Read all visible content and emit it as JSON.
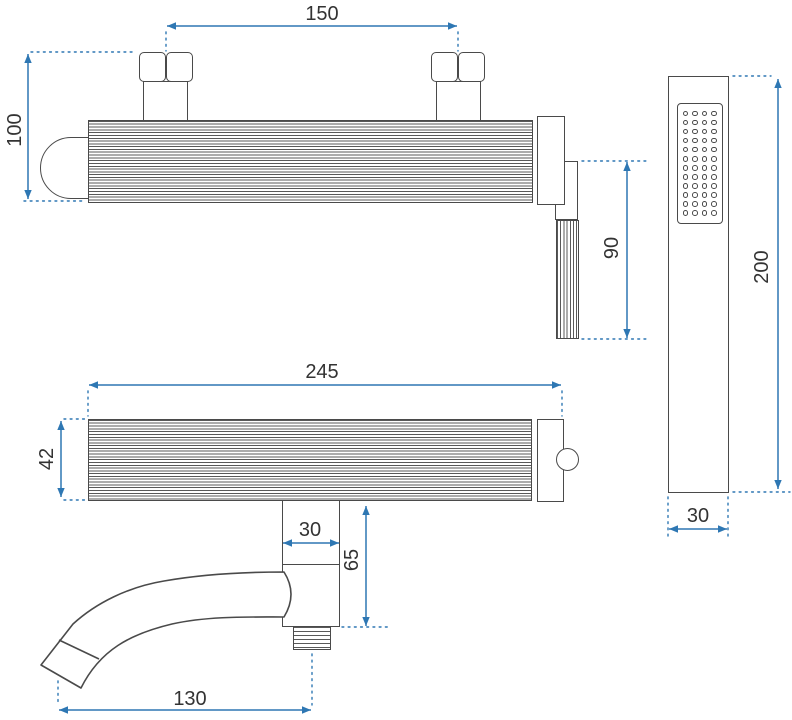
{
  "drawing": {
    "type": "technical dimension drawing",
    "subject": "wall-mounted bath shower mixer with hand shower",
    "unit": "mm",
    "colors": {
      "outline": "#4a4a4a",
      "dimension": "#2e77b3",
      "label": "#333333",
      "background": "#ffffff"
    }
  },
  "views": {
    "front": {
      "name": "mixer front view",
      "dims": {
        "mount_spacing": "150",
        "height": "100",
        "hose_outlet_length": "90"
      }
    },
    "bottom": {
      "name": "mixer bottom view",
      "dims": {
        "length": "245",
        "depth": "42",
        "spout_block_width": "30",
        "spout_block_height": "65",
        "spout_reach": "130"
      }
    },
    "hand_shower": {
      "name": "hand shower front view",
      "dims": {
        "length": "200",
        "width": "30"
      },
      "spray_rows": 12,
      "spray_cols": 4
    }
  }
}
